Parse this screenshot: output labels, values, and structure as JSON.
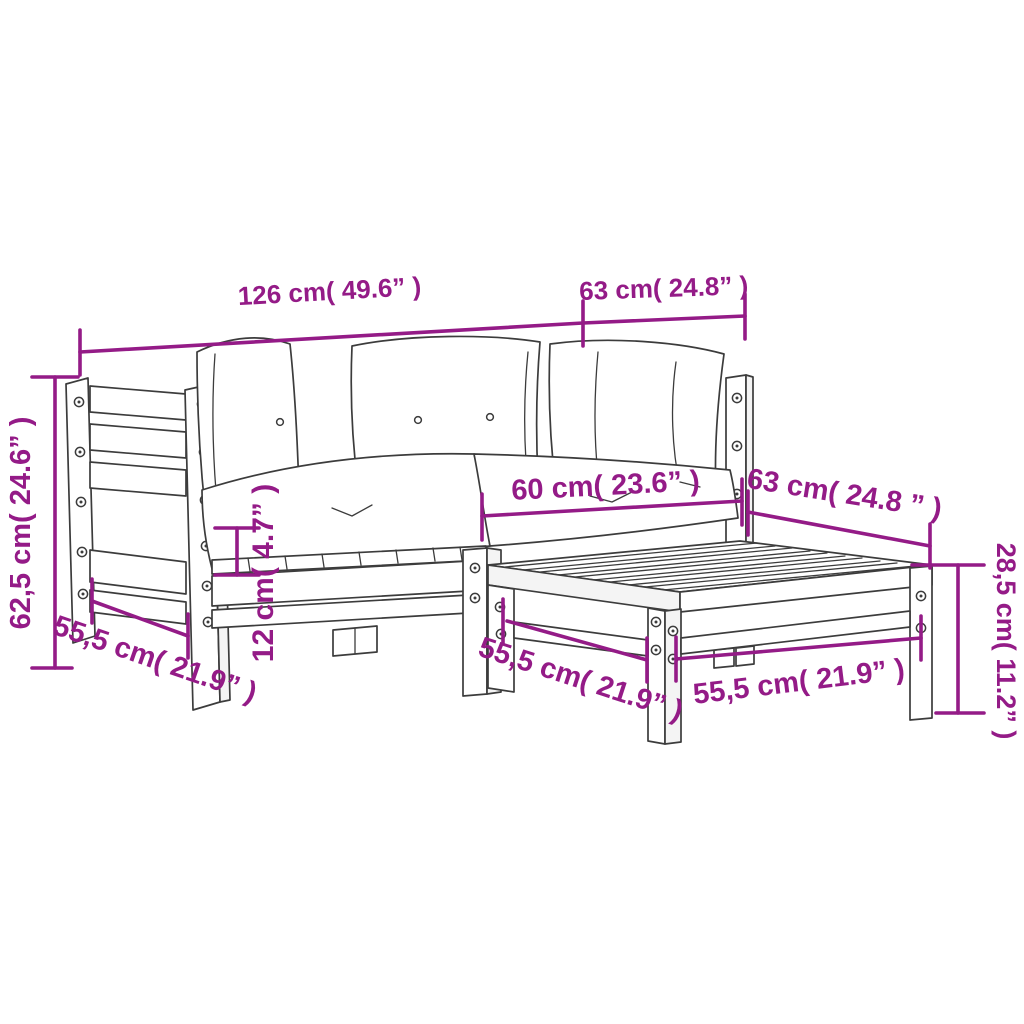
{
  "diagram": {
    "type": "furniture-dimension-diagram",
    "subject": "3-piece wooden garden corner sofa set with cushions and footstool",
    "colors": {
      "dimension_accent": "#941b87",
      "line_art": "#3c3c3c",
      "background": "#ffffff"
    },
    "dimensions": {
      "sofa_total_width": "126 cm( 49.6” )",
      "corner_section_width": "63 cm( 24.8” )",
      "sofa_height": "62,5 cm( 24.6” )",
      "sofa_depth": "55,5 cm( 21.9” )",
      "cushion_thickness": "12 cm( 4.7” )",
      "seat_width": "60 cm( 23.6” )",
      "stool_top_width": "63 cm( 24.8 ” )",
      "stool_depth": "55,5 cm( 21.9” )",
      "stool_front_width": "55,5 cm( 21.9” )",
      "stool_height": "28,5 cm( 11.2” )"
    }
  }
}
